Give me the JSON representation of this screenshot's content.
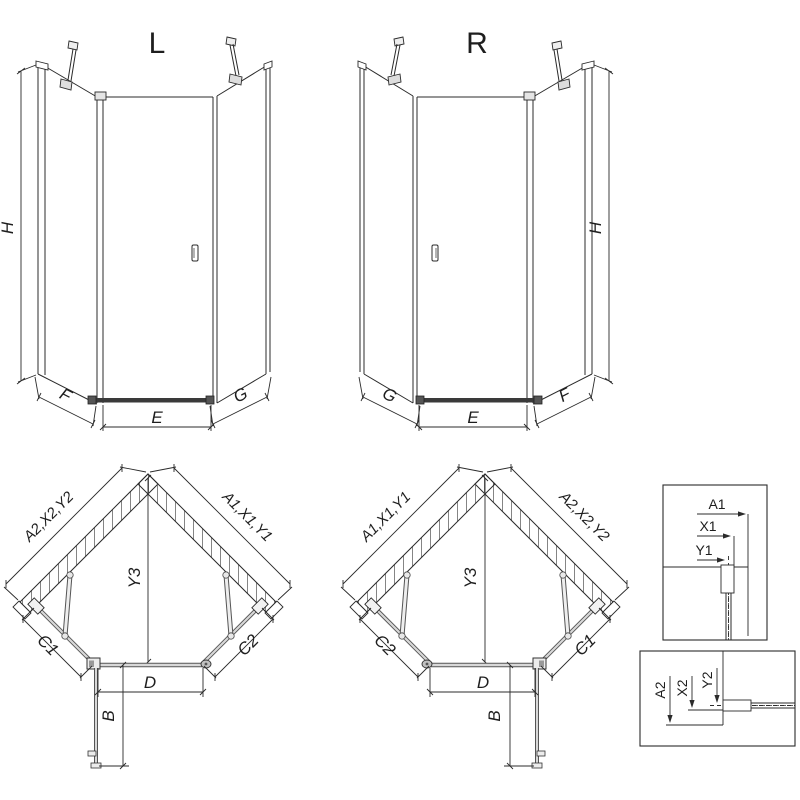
{
  "drawing": {
    "front_views": [
      {
        "id": "L",
        "title": "L",
        "dim_height": "H",
        "dim_bottom_left": "F",
        "dim_bottom_center": "E",
        "dim_bottom_right": "G"
      },
      {
        "id": "R",
        "title": "R",
        "dim_height": "H",
        "dim_bottom_left": "G",
        "dim_bottom_center": "E",
        "dim_bottom_right": "F"
      }
    ],
    "plan_views": [
      {
        "id": "L",
        "wall_upper_left": "A2,X2,Y2",
        "wall_upper_right": "A1,X1,Y1",
        "dim_center": "Y3",
        "dim_lower_left": "C1",
        "dim_lower_right": "C2",
        "dim_door": "D",
        "dim_door_open": "B"
      },
      {
        "id": "R",
        "wall_upper_left": "A1,X1,Y1",
        "wall_upper_right": "A2,X2,Y2",
        "dim_center": "Y3",
        "dim_lower_left": "C2",
        "dim_lower_right": "C1",
        "dim_door": "D",
        "dim_door_open": "B"
      }
    ],
    "details": [
      {
        "labels": [
          "A1",
          "X1",
          "Y1"
        ]
      },
      {
        "labels": [
          "A2",
          "X2",
          "Y2"
        ]
      }
    ],
    "colors": {
      "line": "#2b2b2b",
      "sill_dark": "#3a3a3a",
      "glass_edge": "#555555",
      "glass_light": "#d8d8d8",
      "fill_light": "#ececec"
    }
  }
}
